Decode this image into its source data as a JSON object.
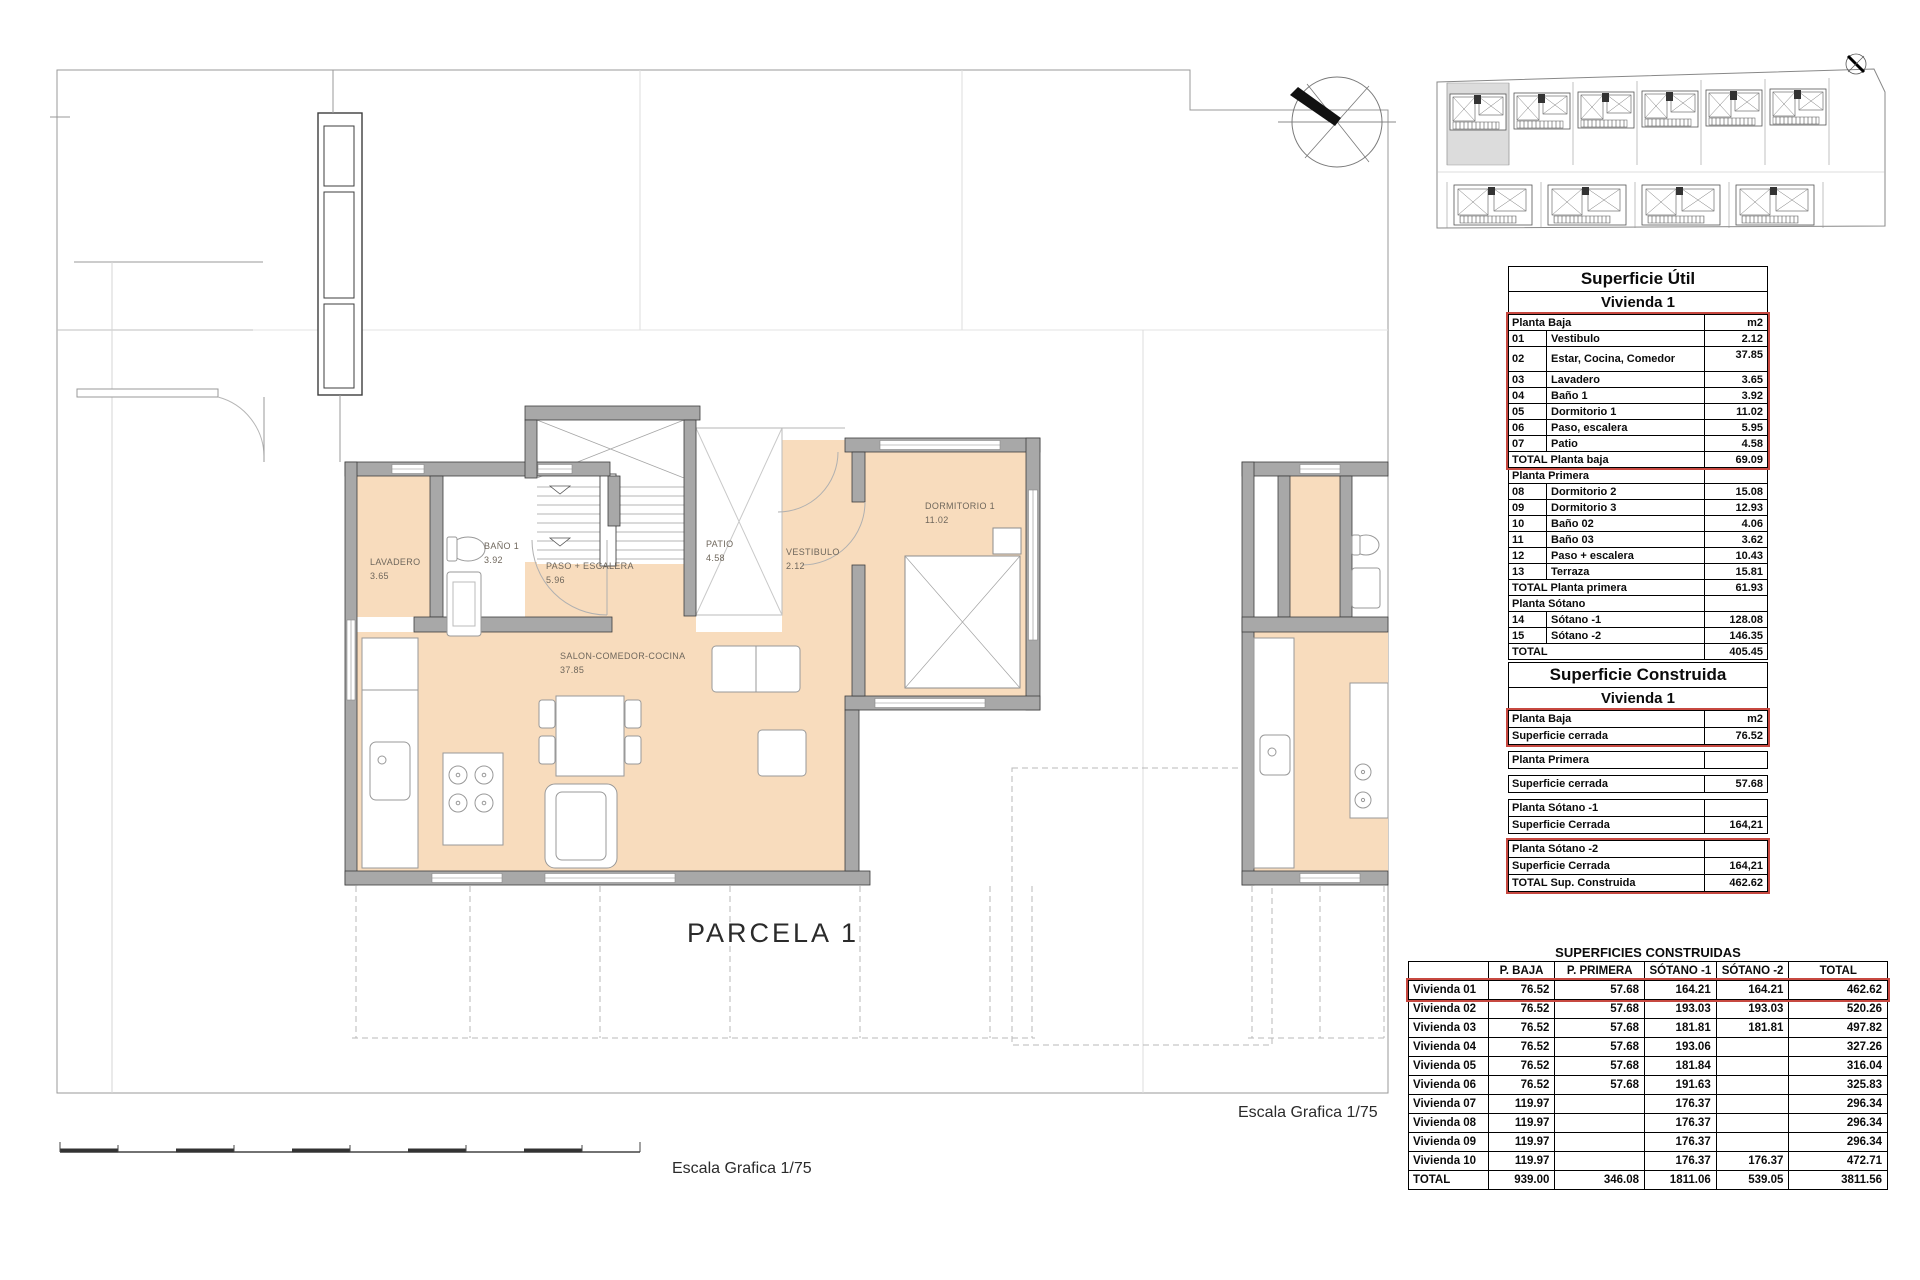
{
  "colors": {
    "accent_red": "#c74840",
    "room_fill": "#f8dcbd",
    "wall_gray": "#a8a8a8"
  },
  "plan": {
    "parcela_label": "PARCELA 1",
    "escala_bottom": "Escala Grafica 1/75",
    "escala_right": "Escala Grafica 1/75",
    "rooms": {
      "lavadero": {
        "name": "LAVADERO",
        "area": "3.65"
      },
      "bano": {
        "name": "BAÑO 1",
        "area": "3.92"
      },
      "paso": {
        "name": "PASO + ESCALERA",
        "area": "5.96"
      },
      "patio": {
        "name": "PATIO",
        "area": "4.58"
      },
      "vestibulo": {
        "name": "VESTIBULO",
        "area": "2.12"
      },
      "dormitorio": {
        "name": "DORMITORIO 1",
        "area": "11.02"
      },
      "salon": {
        "name": "SALON-COMEDOR-COCINA",
        "area": "37.85"
      }
    }
  },
  "superficie_util": {
    "title": "Superficie Útil",
    "subtitle": "Vivienda 1",
    "unit": "m2",
    "planta_baja_header": "Planta Baja",
    "planta_baja_rows": [
      {
        "num": "01",
        "name": "Vestibulo",
        "value": "2.12"
      },
      {
        "num": "02",
        "name": "Estar, Cocina, Comedor",
        "value": "37.85"
      },
      {
        "num": "03",
        "name": "Lavadero",
        "value": "3.65"
      },
      {
        "num": "04",
        "name": "Baño 1",
        "value": "3.92"
      },
      {
        "num": "05",
        "name": "Dormitorio 1",
        "value": "11.02"
      },
      {
        "num": "06",
        "name": "Paso, escalera",
        "value": "5.95"
      },
      {
        "num": "07",
        "name": "Patio",
        "value": "4.58"
      }
    ],
    "planta_baja_total_label": "TOTAL Planta baja",
    "planta_baja_total": "69.09",
    "planta_primera_header": "Planta Primera",
    "planta_primera_rows": [
      {
        "num": "08",
        "name": "Dormitorio 2",
        "value": "15.08"
      },
      {
        "num": "09",
        "name": "Dormitorio 3",
        "value": "12.93"
      },
      {
        "num": "10",
        "name": "Baño 02",
        "value": "4.06"
      },
      {
        "num": "11",
        "name": "Baño 03",
        "value": "3.62"
      },
      {
        "num": "12",
        "name": "Paso + escalera",
        "value": "10.43"
      },
      {
        "num": "13",
        "name": "Terraza",
        "value": "15.81"
      }
    ],
    "planta_primera_total_label": "TOTAL Planta primera",
    "planta_primera_total": "61.93",
    "planta_sotano_header": "Planta Sótano",
    "planta_sotano_rows": [
      {
        "num": "14",
        "name": "Sótano -1",
        "value": "128.08"
      },
      {
        "num": "15",
        "name": "Sótano -2",
        "value": "146.35"
      }
    ],
    "total_label": "TOTAL",
    "total": "405.45"
  },
  "superficie_construida": {
    "title": "Superficie Construida",
    "subtitle": "Vivienda 1",
    "unit": "m2",
    "pb_header": "Planta Baja",
    "pb_row_label": "Superficie cerrada",
    "pb_row_value": "76.52",
    "pp_header": "Planta Primera",
    "pp_row_label": "Superficie cerrada",
    "pp_row_value": "57.68",
    "ps1_header": "Planta Sótano -1",
    "ps1_row_label": "Superficie Cerrada",
    "ps1_row_value": "164,21",
    "ps2_header": "Planta Sótano -2",
    "ps2_row_label": "Superficie Cerrada",
    "ps2_row_value": "164,21",
    "total_label": "TOTAL Sup. Construida",
    "total_value": "462.62"
  },
  "superficies_construidas": {
    "title": "SUPERFICIES CONSTRUIDAS",
    "col_pbaja": "P. BAJA",
    "col_primera": "P. PRIMERA",
    "col_s1": "SÓTANO -1",
    "col_s2": "SÓTANO -2",
    "col_total": "TOTAL",
    "rows": [
      {
        "label": "Vivienda 01",
        "b": "76.52",
        "p": "57.68",
        "s1": "164.21",
        "s2": "164.21",
        "t": "462.62"
      },
      {
        "label": "Vivienda 02",
        "b": "76.52",
        "p": "57.68",
        "s1": "193.03",
        "s2": "193.03",
        "t": "520.26"
      },
      {
        "label": "Vivienda 03",
        "b": "76.52",
        "p": "57.68",
        "s1": "181.81",
        "s2": "181.81",
        "t": "497.82"
      },
      {
        "label": "Vivienda 04",
        "b": "76.52",
        "p": "57.68",
        "s1": "193.06",
        "s2": "",
        "t": "327.26"
      },
      {
        "label": "Vivienda 05",
        "b": "76.52",
        "p": "57.68",
        "s1": "181.84",
        "s2": "",
        "t": "316.04"
      },
      {
        "label": "Vivienda 06",
        "b": "76.52",
        "p": "57.68",
        "s1": "191.63",
        "s2": "",
        "t": "325.83"
      },
      {
        "label": "Vivienda 07",
        "b": "119.97",
        "p": "",
        "s1": "176.37",
        "s2": "",
        "t": "296.34"
      },
      {
        "label": "Vivienda 08",
        "b": "119.97",
        "p": "",
        "s1": "176.37",
        "s2": "",
        "t": "296.34"
      },
      {
        "label": "Vivienda 09",
        "b": "119.97",
        "p": "",
        "s1": "176.37",
        "s2": "",
        "t": "296.34"
      },
      {
        "label": "Vivienda 10",
        "b": "119.97",
        "p": "",
        "s1": "176.37",
        "s2": "176.37",
        "t": "472.71"
      },
      {
        "label": "TOTAL",
        "b": "939.00",
        "p": "346.08",
        "s1": "1811.06",
        "s2": "539.05",
        "t": "3811.56"
      }
    ]
  }
}
